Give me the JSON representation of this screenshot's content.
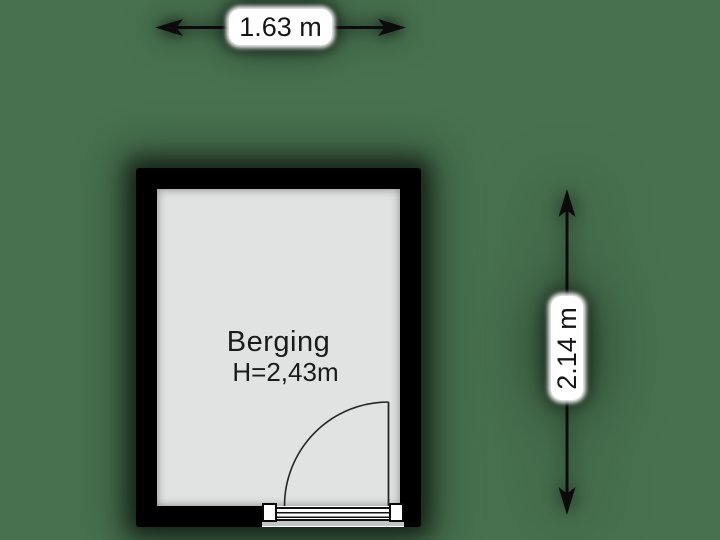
{
  "background_color": "#47714f",
  "room": {
    "name": "Berging",
    "ceiling_height": "H=2,43m",
    "fill_color": "#e1e3e3",
    "wall_color": "#000000",
    "text_color": "#1a1a1a"
  },
  "dimensions": {
    "width": {
      "label": "1.63 m"
    },
    "height": {
      "label": "2.14 m"
    },
    "line_color": "#0b0b0b",
    "label_box_color": "#ffffff"
  }
}
